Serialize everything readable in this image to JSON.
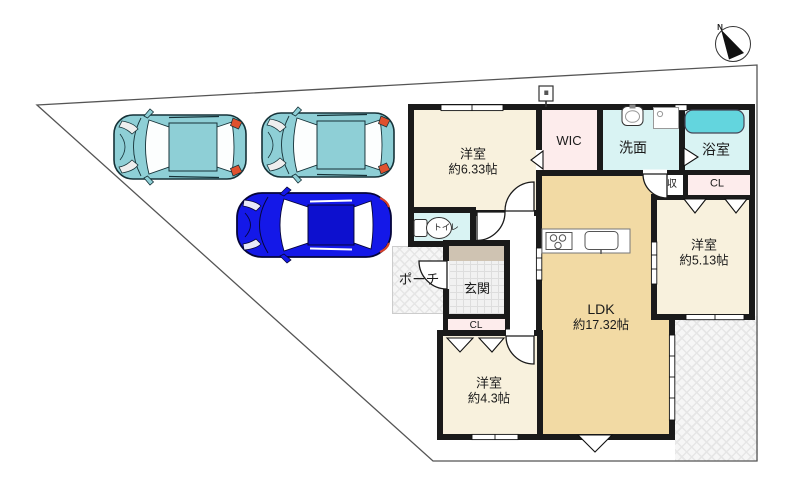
{
  "plan": {
    "rooms": {
      "bedroom_633": {
        "label": "洋室",
        "size": "約6.33帖"
      },
      "wic": {
        "label": "WIC"
      },
      "washroom": {
        "label": "洗面"
      },
      "bathroom": {
        "label": "浴室"
      },
      "storage": {
        "label": "収"
      },
      "closet_upper": {
        "label": "CL"
      },
      "bedroom_513": {
        "label": "洋室",
        "size": "約5.13帖"
      },
      "ldk": {
        "label": "LDK",
        "size": "約17.32帖"
      },
      "toilet": {
        "label": "トイレ"
      },
      "entrance": {
        "label": "玄関"
      },
      "porch": {
        "label": "ポーチ"
      },
      "closet_lower": {
        "label": "CL"
      },
      "bedroom_43": {
        "label": "洋室",
        "size": "約4.3帖"
      }
    },
    "compass": {
      "north_label": "N"
    },
    "cars": [
      {
        "style": "hatchback",
        "color": "teal"
      },
      {
        "style": "hatchback",
        "color": "teal"
      },
      {
        "style": "sedan",
        "color": "blue"
      }
    ],
    "colors": {
      "wall": "#1a1a1a",
      "bedroom_floor": "#f8f1dd",
      "ldk_floor": "#f2daa4",
      "closet_floor": "#fdecec",
      "wet_floor": "#d9f3f3",
      "bathtub": "#63d5de",
      "entrance_step": "#cfc3b2",
      "car_teal": "#8ecfd6",
      "car_blue": "#1418e8",
      "boundary_line": "#555555"
    }
  }
}
